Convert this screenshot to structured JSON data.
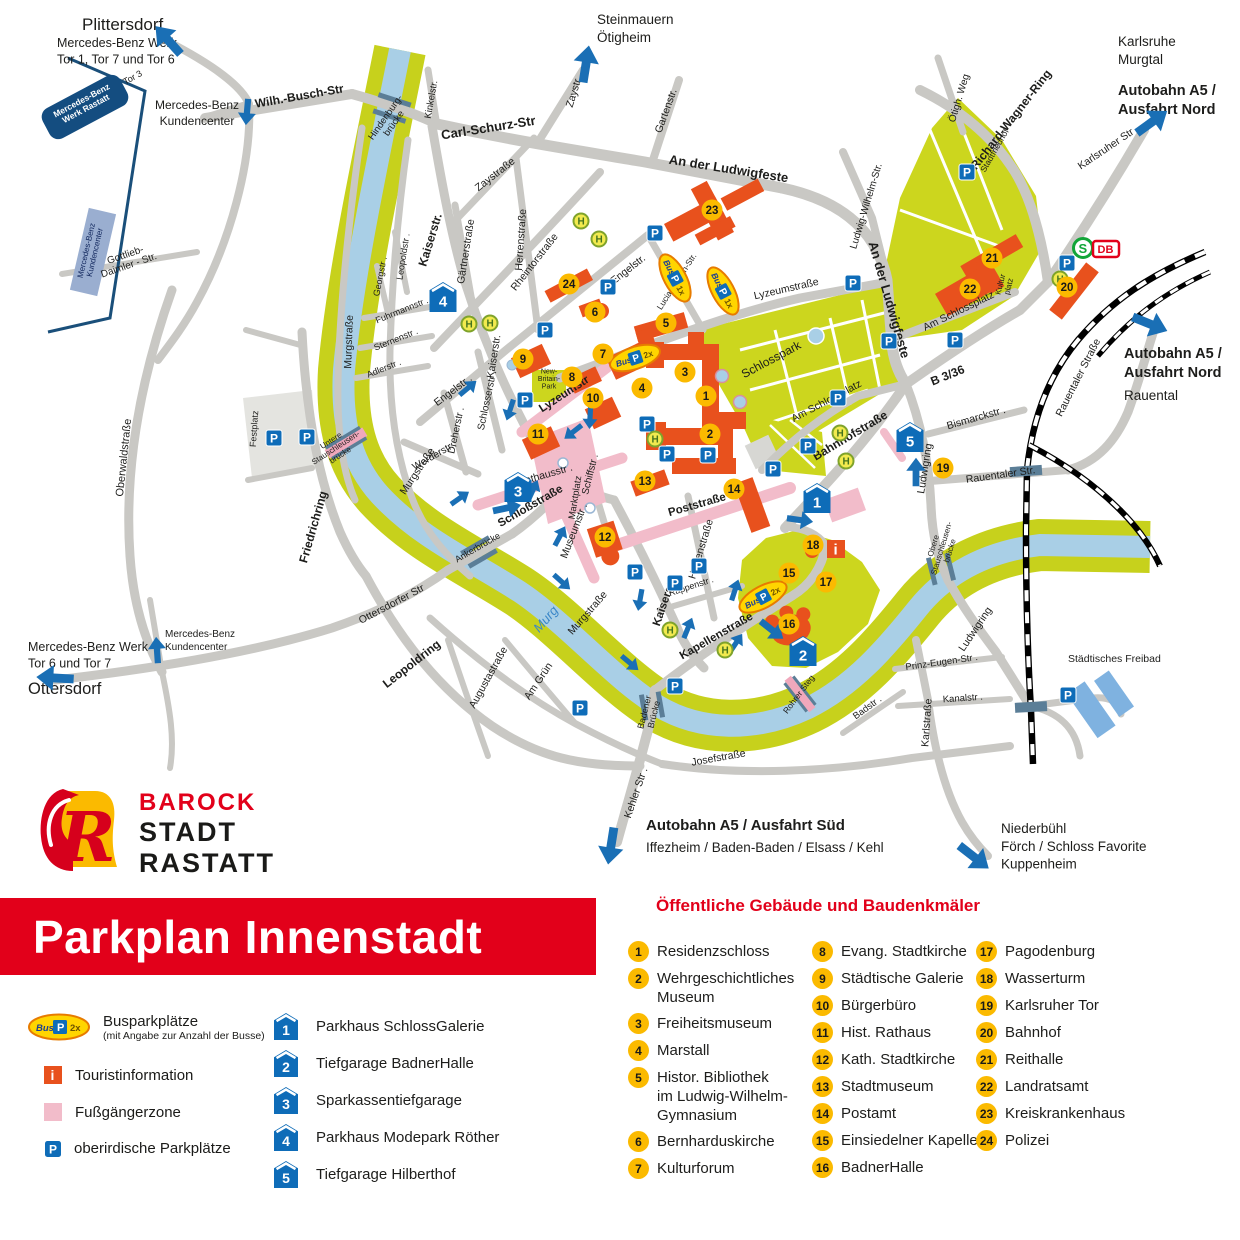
{
  "title": "Parkplan Innenstadt",
  "logo": {
    "letter": "R",
    "line1": "BAROCK",
    "line2": "STADT",
    "line3": "RASTATT"
  },
  "legend": {
    "bus_label": "Busparkplätze",
    "bus_sub": "(mit Angabe zur Anzahl der Busse)",
    "bus_badge": "2x",
    "info_label": "Touristinformation",
    "zone_label": "Fußgängerzone",
    "parking_label": "oberirdische Parkplätze",
    "garages": [
      "Parkhaus SchlossGalerie",
      "Tiefgarage BadnerHalle",
      "Sparkassentiefgarage",
      "Parkhaus Modepark Röther",
      "Tiefgarage Hilberthof"
    ]
  },
  "buildings": {
    "header": "Öffentliche Gebäude und Baudenkmäler",
    "columns": [
      [
        [
          1,
          "Residenzschloss"
        ],
        [
          2,
          "Wehrgeschichtliches\nMuseum"
        ],
        [
          3,
          "Freiheitsmuseum"
        ],
        [
          4,
          "Marstall"
        ],
        [
          5,
          "Histor. Bibliothek\nim Ludwig-Wilhelm-\nGymnasium"
        ],
        [
          6,
          "Bernharduskirche"
        ],
        [
          7,
          "Kulturforum"
        ]
      ],
      [
        [
          8,
          "Evang. Stadtkirche"
        ],
        [
          9,
          "Städtische Galerie"
        ],
        [
          10,
          "Bürgerbüro"
        ],
        [
          11,
          "Hist. Rathaus"
        ],
        [
          12,
          "Kath. Stadtkirche"
        ],
        [
          13,
          "Stadtmuseum"
        ],
        [
          14,
          "Postamt"
        ],
        [
          15,
          "Einsiedelner Kapelle"
        ],
        [
          16,
          "BadnerHalle"
        ]
      ],
      [
        [
          17,
          "Pagodenburg"
        ],
        [
          18,
          "Wasserturm"
        ],
        [
          19,
          "Karlsruher Tor"
        ],
        [
          20,
          "Bahnhof"
        ],
        [
          21,
          "Reithalle"
        ],
        [
          22,
          "Landratsamt"
        ],
        [
          23,
          "Kreiskrankenhaus"
        ],
        [
          24,
          "Polizei"
        ]
      ]
    ]
  },
  "map": {
    "colors": {
      "road": "#c9c8c4",
      "water": "#a9cfe6",
      "bank": "#c7d11c",
      "building": "#e8511d",
      "marker": "#fbba00",
      "blue": "#0e6cb8",
      "pink": "#f2bcca",
      "rail_bridge": "#5b7e97",
      "accent_red": "#e2001a"
    },
    "destinations": [
      {
        "l": [
          "Plittersdorf"
        ],
        "x": 82,
        "y": 30,
        "s": 17
      },
      {
        "l": [
          "Mercedes-Benz Werk",
          "Tor 1, Tor 7 und Tor 6"
        ],
        "x": 57,
        "y": 47,
        "s": 12.5
      },
      {
        "l": [
          "Mercedes-Benz",
          "Kundencenter"
        ],
        "x": 197,
        "y": 109,
        "s": 12,
        "a": "middle"
      },
      {
        "l": [
          "Steinmauern",
          "Ötigheim"
        ],
        "x": 597,
        "y": 24,
        "s": 13.5
      },
      {
        "l": [
          "Karlsruhe",
          "Murgtal"
        ],
        "x": 1118,
        "y": 46,
        "s": 13.5
      },
      {
        "l": [
          "Autobahn A5 /",
          "Ausfahrt Nord"
        ],
        "x": 1118,
        "y": 95,
        "s": 14.5,
        "b": 1
      },
      {
        "l": [
          "Autobahn A5 /",
          "Ausfahrt Nord"
        ],
        "x": 1124,
        "y": 358,
        "s": 14.5,
        "b": 1
      },
      {
        "l": [
          "Rauental"
        ],
        "x": 1124,
        "y": 400,
        "s": 13.5
      },
      {
        "l": [
          "Autobahn A5 / Ausfahrt Süd"
        ],
        "x": 646,
        "y": 830,
        "s": 15,
        "b": 1
      },
      {
        "l": [
          "Iffezheim / Baden-Baden / Elsass / Kehl"
        ],
        "x": 646,
        "y": 852,
        "s": 13.5
      },
      {
        "l": [
          "Niederbühl",
          "Förch / Schloss Favorite",
          "Kuppenheim"
        ],
        "x": 1001,
        "y": 833,
        "s": 13.5
      },
      {
        "l": [
          "Mercedes-Benz Werk",
          "Tor 6 und Tor 7"
        ],
        "x": 28,
        "y": 651,
        "s": 12.5
      },
      {
        "l": [
          "Ottersdorf"
        ],
        "x": 28,
        "y": 694,
        "s": 16.5
      },
      {
        "l": [
          "Mercedes-Benz",
          "Kundencenter"
        ],
        "x": 165,
        "y": 637,
        "s": 10
      },
      {
        "l": [
          "Städtisches Freibad"
        ],
        "x": 1068,
        "y": 662,
        "s": 10.5
      }
    ],
    "street_labels": [
      [
        "Wilh.-Busch-Str",
        300,
        100,
        -10,
        12,
        "b"
      ],
      [
        "Hindenburg-|brücke",
        392,
        122,
        -55,
        9.5
      ],
      [
        "Carl-Schurz-Str",
        489,
        132,
        -9,
        13,
        "b"
      ],
      [
        "Kinkelstr.",
        434,
        100,
        -80,
        9.5
      ],
      [
        "Zaystr.",
        577,
        93,
        -73,
        10.5
      ],
      [
        "Zaystraße",
        497,
        177,
        -38,
        10.5
      ],
      [
        "Gärtnerstraße",
        469,
        252,
        -81,
        10.5
      ],
      [
        "Herrenstraße",
        524,
        240,
        -86,
        10.5
      ],
      [
        "Rheintorstraße",
        537,
        264,
        -52,
        10.5
      ],
      [
        "Gartenstr.",
        669,
        112,
        -70,
        10.5
      ],
      [
        "An der Ludwigfeste",
        728,
        173,
        9,
        13,
        "b"
      ],
      [
        "Engelstr.",
        630,
        272,
        -38,
        10.5
      ],
      [
        "Lucian-Reich-Str.",
        679,
        283,
        -57,
        8.5
      ],
      [
        "Lyzeumstraße",
        787,
        292,
        -13,
        10.5
      ],
      [
        "Ludwig-Wilhelm-Str.",
        869,
        207,
        -73,
        10
      ],
      [
        "Ötigh.  Weg",
        962,
        99,
        -73,
        10
      ],
      [
        "Richard-Wagner-Ring",
        1014,
        122,
        -52,
        12,
        "b"
      ],
      [
        "Stadtfriedhof",
        997,
        152,
        -60,
        8.5
      ],
      [
        "Karlsruher Str .",
        1110,
        150,
        -34,
        10.5
      ],
      [
        "Kaiserstr.",
        434,
        241,
        -73,
        12,
        "b"
      ],
      [
        "Leopoldstr .",
        406,
        257,
        -81,
        9
      ],
      [
        "Georgstr .",
        383,
        277,
        -79,
        9
      ],
      [
        "Fuhrmannstr .",
        403,
        313,
        -22,
        9
      ],
      [
        "Sternenstr .",
        397,
        342,
        -22,
        9
      ],
      [
        "Adlerstr .",
        385,
        371,
        -22,
        9
      ],
      [
        "Murgstraße",
        352,
        342,
        -88,
        10.5
      ],
      [
        "Oberwaldstraße",
        127,
        458,
        -84,
        11
      ],
      [
        "Festplatz",
        257,
        429,
        -86,
        9
      ],
      [
        "Untere|Stauschleusen-|brücke",
        337,
        450,
        -33,
        8
      ],
      [
        "Friedrichring",
        317,
        528,
        -74,
        12,
        "b"
      ],
      [
        "Engelstr .",
        455,
        393,
        -37,
        10.5
      ],
      [
        "Dreherstr .",
        459,
        431,
        -78,
        10
      ],
      [
        "Schlosserstr .",
        490,
        401,
        -78,
        10
      ],
      [
        "Werderstr .",
        436,
        458,
        -30,
        10
      ],
      [
        "Kaiserstr.",
        497,
        357,
        -81,
        10.5
      ],
      [
        "Rathausstr .",
        546,
        478,
        -16,
        10.5
      ],
      [
        "Marktplatz",
        578,
        498,
        -81,
        9.5
      ],
      [
        "Schiffstr .",
        593,
        475,
        -76,
        10
      ],
      [
        "Lyzeumstr",
        566,
        397,
        -33,
        11.5,
        "b"
      ],
      [
        "Museumstr .",
        577,
        532,
        -69,
        10.5
      ],
      [
        "Schloßstraße",
        532,
        509,
        -30,
        11.5,
        "b"
      ],
      [
        "Ankerbrücke",
        479,
        550,
        -30,
        9
      ],
      [
        "Murgstraße",
        420,
        473,
        -56,
        10.5
      ],
      [
        "Murgstraße",
        590,
        615,
        -49,
        10.5
      ],
      [
        "Murg",
        549,
        622,
        -49,
        13,
        "iu"
      ],
      [
        "Poststraße",
        698,
        508,
        -16,
        11.5,
        "b"
      ],
      [
        "Herrenstraße",
        704,
        550,
        -73,
        10.5
      ],
      [
        "Rappenstr .",
        692,
        589,
        -18,
        9
      ],
      [
        "Kaiserstr.",
        668,
        602,
        -71,
        11.5,
        "b"
      ],
      [
        "Kapellenstraße",
        718,
        639,
        -30,
        11.5,
        "b"
      ],
      [
        "Leopoldring",
        414,
        667,
        -38,
        12,
        "b"
      ],
      [
        "Ottersdorfer Str",
        393,
        607,
        -28,
        10.5
      ],
      [
        "Augustastraße",
        491,
        679,
        -61,
        10.5
      ],
      [
        "Am Grün",
        541,
        683,
        -56,
        10.5
      ],
      [
        "Badener|Brücke",
        652,
        714,
        -76,
        9
      ],
      [
        "Kehler Str .",
        639,
        794,
        -71,
        10.5
      ],
      [
        "Josefstraße",
        719,
        761,
        -10,
        10.5
      ],
      [
        "Rohrer Steg",
        801,
        696,
        -53,
        8.5
      ],
      [
        "Bahnhofstraße",
        852,
        439,
        -31,
        12,
        "b"
      ],
      [
        "B 3/36",
        949,
        379,
        -22,
        12,
        "b"
      ],
      [
        "Bismarckstr .",
        977,
        421,
        -16,
        10.5
      ],
      [
        "Ludwigring",
        928,
        469,
        -81,
        10.5
      ],
      [
        "Rauentaler Str.",
        1001,
        478,
        -8,
        10.5
      ],
      [
        "Rauentaler Straße",
        1081,
        379,
        -63,
        10.5
      ],
      [
        "Obere|Stauschleusen-|brücke",
        944,
        549,
        -73,
        8
      ],
      [
        "Ludwigring",
        978,
        631,
        -56,
        10.5
      ],
      [
        "Prinz-Eugen-Str .",
        942,
        665,
        -8,
        9.5
      ],
      [
        "Kanalstr .",
        963,
        701,
        -4,
        9.5
      ],
      [
        "Badstr .",
        869,
        710,
        -36,
        9.5
      ],
      [
        "Karlstraße",
        930,
        723,
        -86,
        10.5
      ],
      [
        "Schlosspark",
        773,
        363,
        -28,
        12
      ],
      [
        "Am Schlossplatz",
        828,
        404,
        -28,
        10.5
      ],
      [
        "Am Schlossplatz",
        960,
        314,
        -26,
        10.5
      ],
      [
        "Kultur|platz",
        1007,
        286,
        -76,
        8
      ],
      [
        "An der Ludwigfeste",
        885,
        301,
        74,
        13,
        "b"
      ],
      [
        "New-|Britain-|Park",
        549,
        381,
        0,
        7
      ],
      [
        "Gottlieb-|Daimler - Str.",
        128,
        263,
        -19,
        10
      ],
      [
        "Tor 3",
        134,
        80,
        -29,
        9
      ],
      [
        "Mercedes-Benz|Werk Rastatt",
        85,
        107,
        -28,
        8.5,
        "bw"
      ],
      [
        "Mercedes-Benz|Kundencenter",
        93,
        252,
        -77,
        8,
        "d"
      ]
    ],
    "markers": [
      [
        1,
        706,
        396
      ],
      [
        2,
        710,
        434
      ],
      [
        3,
        685,
        372
      ],
      [
        4,
        642,
        388
      ],
      [
        5,
        666,
        323
      ],
      [
        6,
        595,
        312
      ],
      [
        7,
        603,
        354
      ],
      [
        8,
        572,
        377
      ],
      [
        9,
        523,
        359
      ],
      [
        10,
        593,
        398
      ],
      [
        11,
        538,
        434
      ],
      [
        12,
        605,
        537
      ],
      [
        13,
        645,
        481
      ],
      [
        14,
        734,
        489
      ],
      [
        15,
        789,
        573
      ],
      [
        16,
        789,
        624
      ],
      [
        17,
        826,
        582
      ],
      [
        18,
        813,
        545
      ],
      [
        19,
        943,
        468
      ],
      [
        20,
        1067,
        287
      ],
      [
        21,
        992,
        258
      ],
      [
        22,
        970,
        289
      ],
      [
        23,
        712,
        210
      ],
      [
        24,
        569,
        284
      ]
    ],
    "garage_icons": [
      [
        1,
        817,
        498
      ],
      [
        2,
        803,
        651
      ],
      [
        3,
        518,
        487
      ],
      [
        4,
        443,
        297
      ],
      [
        5,
        910,
        437
      ]
    ],
    "p_icons": [
      [
        608,
        287
      ],
      [
        545,
        330
      ],
      [
        525,
        400
      ],
      [
        655,
        233
      ],
      [
        967,
        172
      ],
      [
        1067,
        263
      ],
      [
        853,
        283
      ],
      [
        889,
        341
      ],
      [
        955,
        340
      ],
      [
        647,
        424
      ],
      [
        667,
        454
      ],
      [
        708,
        455
      ],
      [
        808,
        446
      ],
      [
        773,
        469
      ],
      [
        838,
        398
      ],
      [
        274,
        438
      ],
      [
        307,
        437
      ],
      [
        635,
        572
      ],
      [
        675,
        583
      ],
      [
        699,
        566
      ],
      [
        580,
        708
      ],
      [
        675,
        686
      ],
      [
        1068,
        695
      ]
    ],
    "h_icons": [
      [
        581,
        221
      ],
      [
        599,
        239
      ],
      [
        469,
        324
      ],
      [
        490,
        323
      ],
      [
        655,
        439
      ],
      [
        840,
        433
      ],
      [
        846,
        461
      ],
      [
        670,
        630
      ],
      [
        725,
        650
      ],
      [
        1060,
        279
      ]
    ],
    "bus_ovals": [
      [
        "1x",
        675,
        278,
        62
      ],
      [
        "1x",
        723,
        291,
        62
      ],
      [
        "2x",
        635,
        358,
        -18
      ],
      [
        "2x",
        763,
        597,
        -28
      ]
    ],
    "arrows": [
      [
        168,
        40,
        -132,
        1.7
      ],
      [
        247,
        112,
        95,
        1.2
      ],
      [
        586,
        64,
        -81,
        1.7
      ],
      [
        1152,
        122,
        -36,
        1.7
      ],
      [
        1150,
        324,
        22,
        1.7
      ],
      [
        611,
        846,
        99,
        1.7
      ],
      [
        974,
        857,
        38,
        1.7
      ],
      [
        55,
        678,
        183,
        1.7
      ],
      [
        157,
        650,
        -94,
        1.2
      ],
      [
        468,
        388,
        -40,
        1
      ],
      [
        510,
        410,
        108,
        1
      ],
      [
        590,
        418,
        93,
        1
      ],
      [
        573,
        432,
        142,
        1
      ],
      [
        507,
        508,
        -12,
        1.3
      ],
      [
        460,
        498,
        -35,
        1
      ],
      [
        533,
        490,
        -65,
        1
      ],
      [
        560,
        536,
        -62,
        1
      ],
      [
        562,
        582,
        42,
        1
      ],
      [
        640,
        600,
        100,
        1
      ],
      [
        688,
        628,
        -68,
        1
      ],
      [
        735,
        590,
        -72,
        1
      ],
      [
        630,
        663,
        40,
        1
      ],
      [
        800,
        520,
        8,
        1.2
      ],
      [
        916,
        472,
        -90,
        1.3
      ],
      [
        772,
        630,
        38,
        1.3
      ],
      [
        736,
        643,
        -56,
        1
      ]
    ],
    "special": {
      "info_xy": [
        836,
        549
      ],
      "sbahn_xy": [
        1083,
        248
      ],
      "db_xy": [
        1106,
        249
      ],
      "sbahn": "S",
      "db": "DB",
      "info": "i",
      "p": "P",
      "h": "H",
      "bus": "Bus"
    }
  }
}
